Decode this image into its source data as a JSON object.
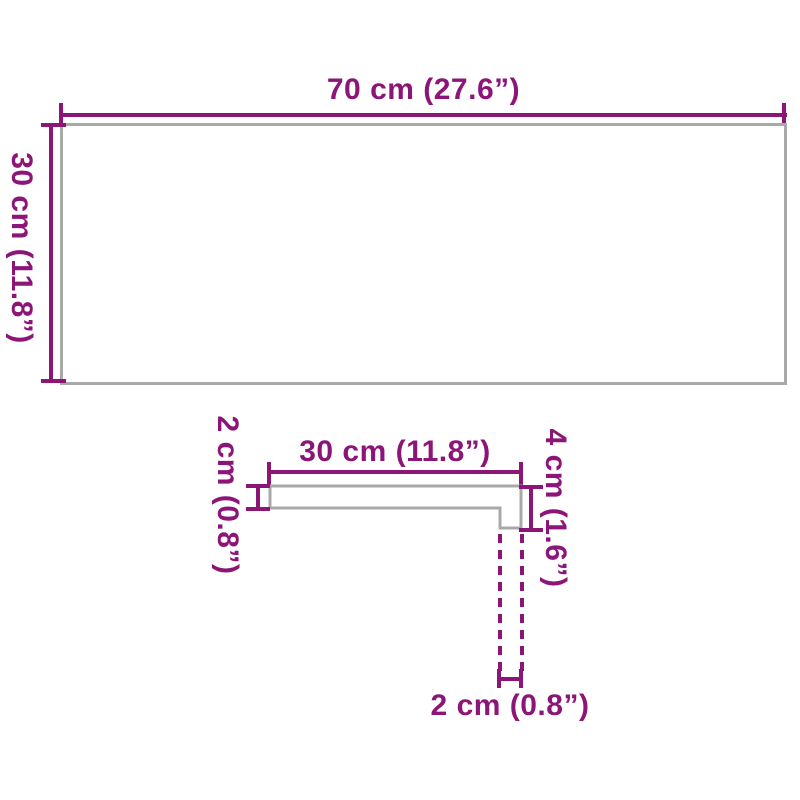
{
  "colors": {
    "accent": "#8C1578",
    "outline": "#A9A9A9",
    "background": "#FFFFFF"
  },
  "top_view": {
    "width_label": "70 cm (27.6”)",
    "height_label": "30 cm (11.8”)"
  },
  "side_profile": {
    "depth_label": "30 cm (11.8”)",
    "thickness_label": "2 cm (0.8”)",
    "front_height_label": "4 cm (1.6”)",
    "nose_width_label": "2 cm (0.8”)"
  }
}
